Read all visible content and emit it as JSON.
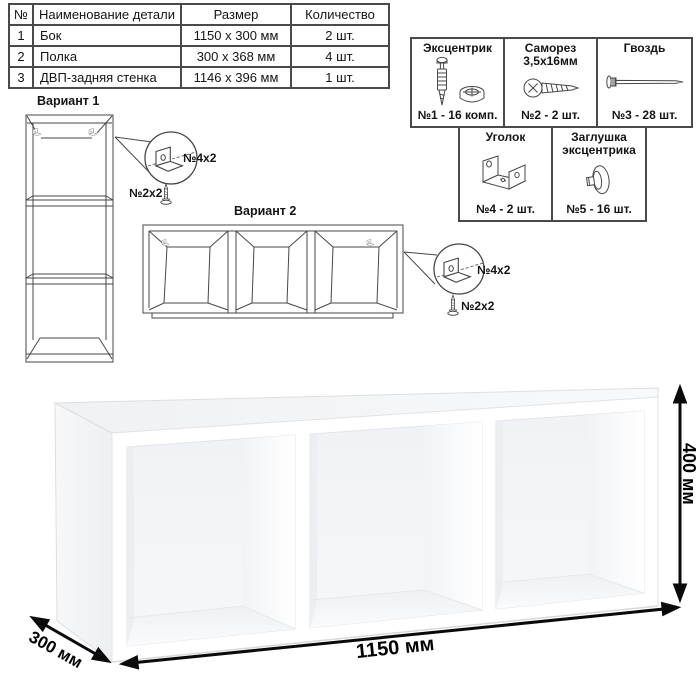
{
  "parts_table": {
    "headers": [
      "№",
      "Наименование детали",
      "Размер",
      "Количество"
    ],
    "rows": [
      {
        "num": "1",
        "name": "Бок",
        "size": "1150 x 300 мм",
        "qty": "2 шт."
      },
      {
        "num": "2",
        "name": "Полка",
        "size": "300 x 368 мм",
        "qty": "4 шт."
      },
      {
        "num": "3",
        "name": "ДВП-задняя стенка",
        "size": "1146 x 396 мм",
        "qty": "1 шт."
      }
    ]
  },
  "hardware": {
    "items": [
      {
        "title": "Эксцентрик",
        "subtitle": "",
        "count": "№1 - 16 комп.",
        "icon": "cam-bolt-and-lock-icon"
      },
      {
        "title": "Саморез",
        "subtitle": "3,5х16мм",
        "count": "№2 - 2 шт.",
        "icon": "screw-icon"
      },
      {
        "title": "Гвоздь",
        "subtitle": "",
        "count": "№3 - 28 шт.",
        "icon": "nail-icon"
      },
      {
        "title": "Уголок",
        "subtitle": "",
        "count": "№4 - 2 шт.",
        "icon": "corner-bracket-icon"
      },
      {
        "title": "Заглушка",
        "subtitle": "эксцентрика",
        "count": "№5 - 16 шт.",
        "icon": "cam-cap-icon"
      }
    ]
  },
  "variant1": {
    "title": "Вариант 1",
    "bracket_label": "№4х2",
    "screw_label": "№2х2"
  },
  "variant2": {
    "title": "Вариант 2",
    "bracket_label": "№4х2",
    "screw_label": "№2х2"
  },
  "dimensions": {
    "width": "1150 мм",
    "depth": "300 мм",
    "height": "400 мм"
  },
  "colors": {
    "line_art": "#474747",
    "table_border": "#4a4a4a",
    "arrow": "#0a0a0a"
  }
}
